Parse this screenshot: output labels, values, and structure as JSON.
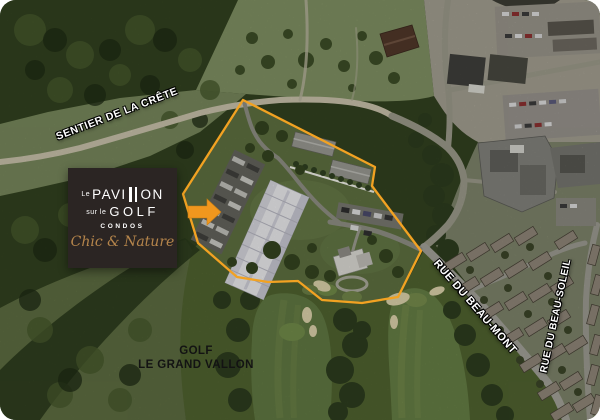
{
  "labels": {
    "trail": "SENTIER DE LA CRÊTE",
    "street_beau_mont": "RUE DU BEAU-MONT",
    "street_beau_soleil": "RUE DU BEAU-SOLEIL",
    "golf_name_line1": "GOLF",
    "golf_name_line2": "LE GRAND VALLON"
  },
  "logo": {
    "prefix": "Le",
    "name_part1": "PAVI",
    "name_part2": "ON",
    "middle_prefix": "sur le",
    "middle_name": "GOLF",
    "subtitle": "CONDOS",
    "tagline": "Chic & Nature"
  },
  "colors": {
    "property_boundary": "#F2A222",
    "highlight_arrow": "#F0971E",
    "logo_background": "#2B2523",
    "tagline_gold": "#B5854B",
    "road_label_white": "#FFFFFF",
    "map_label_black": "#131313"
  }
}
